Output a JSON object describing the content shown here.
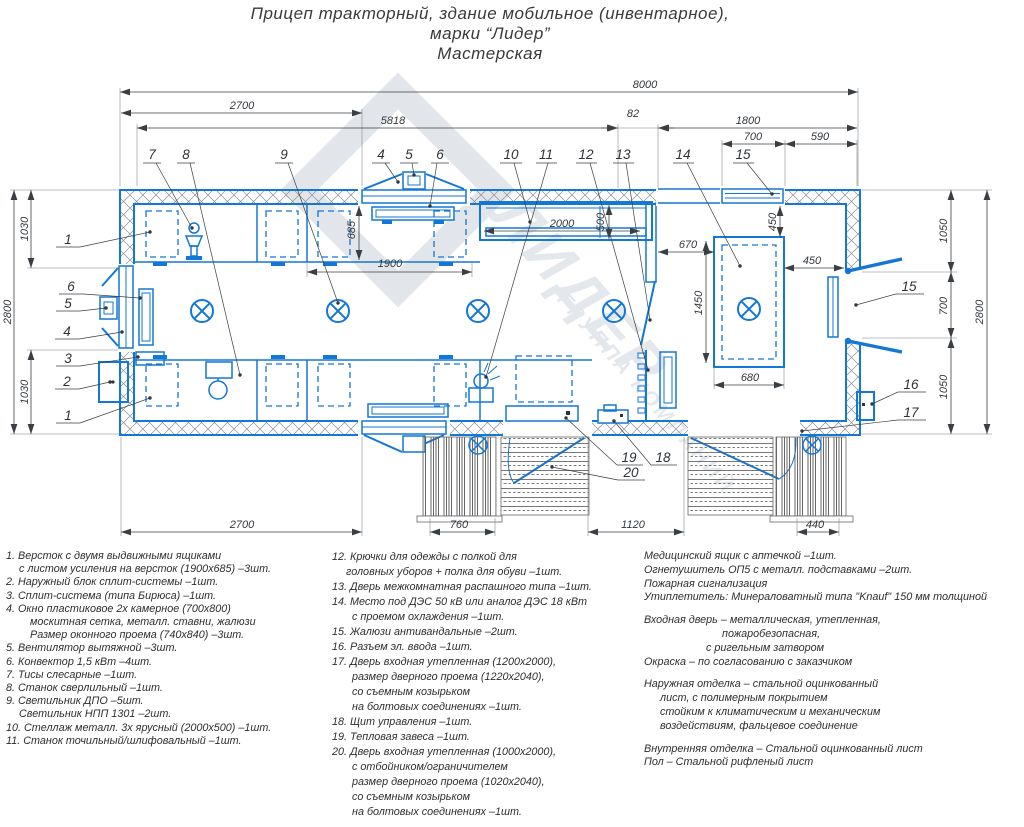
{
  "title": {
    "line1": "Прицеп тракторный, здание мобильное (инвентарное),",
    "line2": "марки “Лидер”",
    "line3": "Мастерская"
  },
  "watermark": {
    "brand": "ЛИДЕР",
    "subtitle": "ГРУППА КОМПАНИЙ"
  },
  "colors": {
    "accent_blue": "#1377d6",
    "dimension": "#3a3f44",
    "watermark": "#e4e8ed"
  },
  "dims": {
    "total_length": "8000",
    "top_left": "2700",
    "top_mid": "5818",
    "partition_gap": "82",
    "top_right": "1800",
    "vent_window": "700",
    "corner": "590",
    "height_left_total": "2800",
    "left_top": "1030",
    "left_bottom": "1030",
    "bench_depth": "685",
    "bench_gap": "1900",
    "rack_length": "2000",
    "rack_depth": "500",
    "genset_offset": "670",
    "genset_length": "1450",
    "genset_top": "450",
    "genset_right": "450",
    "genset_width": "680",
    "right_top": "1050",
    "door_right": "700",
    "right_bottom": "1050",
    "height_right_total": "2800",
    "bottom_left": "2700",
    "stair_left": "760",
    "bottom_mid": "1120",
    "stair_right": "440"
  },
  "callouts": {
    "c1": "1",
    "c2": "2",
    "c3": "3",
    "c4": "4",
    "c5": "5",
    "c6": "6",
    "c7": "7",
    "c8": "8",
    "c9": "9",
    "c10": "10",
    "c11": "11",
    "c12": "12",
    "c13": "13",
    "c14": "14",
    "c15": "15",
    "c16": "16",
    "c17": "17",
    "c18": "18",
    "c19": "19",
    "c20": "20"
  },
  "legend": {
    "col1": [
      {
        "t": "1. Версток с двумя выдвижными ящиками",
        "i": 0
      },
      {
        "t": "с листом усиления на версток (1900х685) –3шт.",
        "i": 13
      },
      {
        "t": "2. Наружный блок сплит-системы –1шт.",
        "i": 0
      },
      {
        "t": "3. Сплит-система (типа Бирюса) –1шт.",
        "i": 0
      },
      {
        "t": "4. Окно пластиковое 2х камерное (700х800)",
        "i": 0
      },
      {
        "t": "москитная сетка, металл. ставни, жалюзи",
        "i": 24
      },
      {
        "t": "Размер оконного проема (740х840) –3шт.",
        "i": 24
      },
      {
        "t": "5. Вентилятор вытяжной –3шт.",
        "i": 0
      },
      {
        "t": "6. Конвектор 1,5 кВт –4шт.",
        "i": 0
      },
      {
        "t": "7. Тисы слесарные –1шт.",
        "i": 0
      },
      {
        "t": "8. Станок сверлильный –1шт.",
        "i": 0
      },
      {
        "t": "9. Светильник ДПО –5шт.",
        "i": 0
      },
      {
        "t": "Светильник НПП 1301 –2шт.",
        "i": 13
      },
      {
        "t": "10. Стеллаж металл. 3х ярусный (2000х500) –1шт.",
        "i": 0
      },
      {
        "t": "11. Станок точильный/шлифовальный –1шт.",
        "i": 0
      }
    ],
    "col2": [
      {
        "t": "12. Крючки для одежды с полкой для",
        "i": 0
      },
      {
        "t": "головных уборов + полка для обуви –1шт.",
        "i": 14
      },
      {
        "t": "13. Дверь межкомнатная распашного типа –1шт.",
        "i": 0
      },
      {
        "t": "14. Место под ДЭС 50 кВ или аналог ДЭС 18 кВт",
        "i": 0
      },
      {
        "t": "с проемом охлаждения –1шт.",
        "i": 20
      },
      {
        "t": "15. Жалюзи антивандальные –2шт.",
        "i": 0
      },
      {
        "t": "16. Разъем эл. ввода –1шт.",
        "i": 0
      },
      {
        "t": "17. Дверь входная утепленная (1200х2000),",
        "i": 0
      },
      {
        "t": "размер дверного проема (1220х2040),",
        "i": 20
      },
      {
        "t": "со съемным козырьком",
        "i": 20
      },
      {
        "t": "на болтовых соединениях –1шт.",
        "i": 20
      },
      {
        "t": "18. Щит управления –1шт.",
        "i": 0
      },
      {
        "t": "19. Тепловая завеса –1шт.",
        "i": 0
      },
      {
        "t": "20. Дверь входная утепленная (1000х2000),",
        "i": 0
      },
      {
        "t": "с отбойником/ограничителем",
        "i": 20
      },
      {
        "t": "размер дверного проема (1020х2040),",
        "i": 20
      },
      {
        "t": "со съемным козырьком",
        "i": 20
      },
      {
        "t": "на болтовых соединениях –1шт.",
        "i": 20
      }
    ],
    "col3": [
      {
        "t": "Медицинский ящик с аптечкой –1шт.",
        "i": 0
      },
      {
        "t": "Огнетушитель ОП5 с металл. подставками –2шт.",
        "i": 0
      },
      {
        "t": "Пожарная сигнализация",
        "i": 0
      },
      {
        "t": "Утиплетитель: Минераловатный типа \"Knauf\" 150 мм толщиной",
        "i": 0
      },
      {
        "t": "",
        "i": 0
      },
      {
        "t": "Входная дверь – металлическая, утепленная,",
        "i": 0
      },
      {
        "t": "пожаробезопасная,",
        "i": 78
      },
      {
        "t": "с ригельным затвором",
        "i": 62
      },
      {
        "t": "Окраска – по согласованию с заказчиком",
        "i": 0
      },
      {
        "t": "",
        "i": 0
      },
      {
        "t": "Наружная отделка – стальной оцинкованный",
        "i": 0
      },
      {
        "t": "лист, с полимерным покрытием",
        "i": 16
      },
      {
        "t": "стойким к климатическим и механическим",
        "i": 16
      },
      {
        "t": "воздействиям, фальцевое соединение",
        "i": 16
      },
      {
        "t": "",
        "i": 0
      },
      {
        "t": "Внутренняя отделка – Стальной оцинкованный лист",
        "i": 0
      },
      {
        "t": "Пол – Стальной рифленый лист",
        "i": 0
      }
    ]
  }
}
